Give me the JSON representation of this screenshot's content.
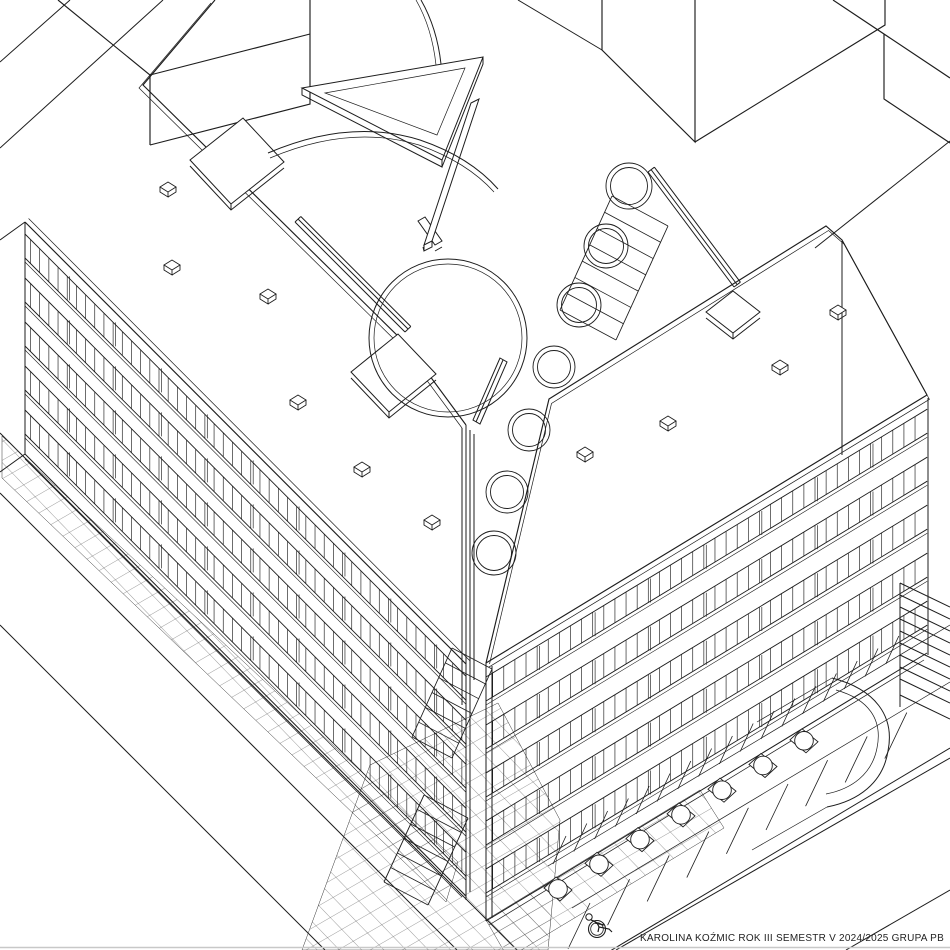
{
  "page": {
    "background": "#ffffff",
    "ink": "#1d1d1d",
    "hatch_ink": "#4a4a4a",
    "border_color": "#c8c8c8"
  },
  "caption": {
    "text": "KAROLINA KOŹMIC ROK III SEMESTR V 2024/2025 GRUPA PB"
  },
  "scene": {
    "type": "architectural axonometric site drawing, black ink on white",
    "left_wing": {
      "floors": 5,
      "roof_vents": 6,
      "window_tick_step": 13
    },
    "right_wing": {
      "floors": 5,
      "roof_vents": 4,
      "window_tick_step": 13
    },
    "courtyard": {
      "planter_circles": 7,
      "stair_flights": 3
    },
    "plaza": {
      "features": [
        "arrow-sculpture",
        "curved-path",
        "circular-planter",
        "footbridge-plates"
      ]
    },
    "parking": {
      "trees": 7,
      "stall_rows": 2,
      "accessible_stall": true
    }
  }
}
